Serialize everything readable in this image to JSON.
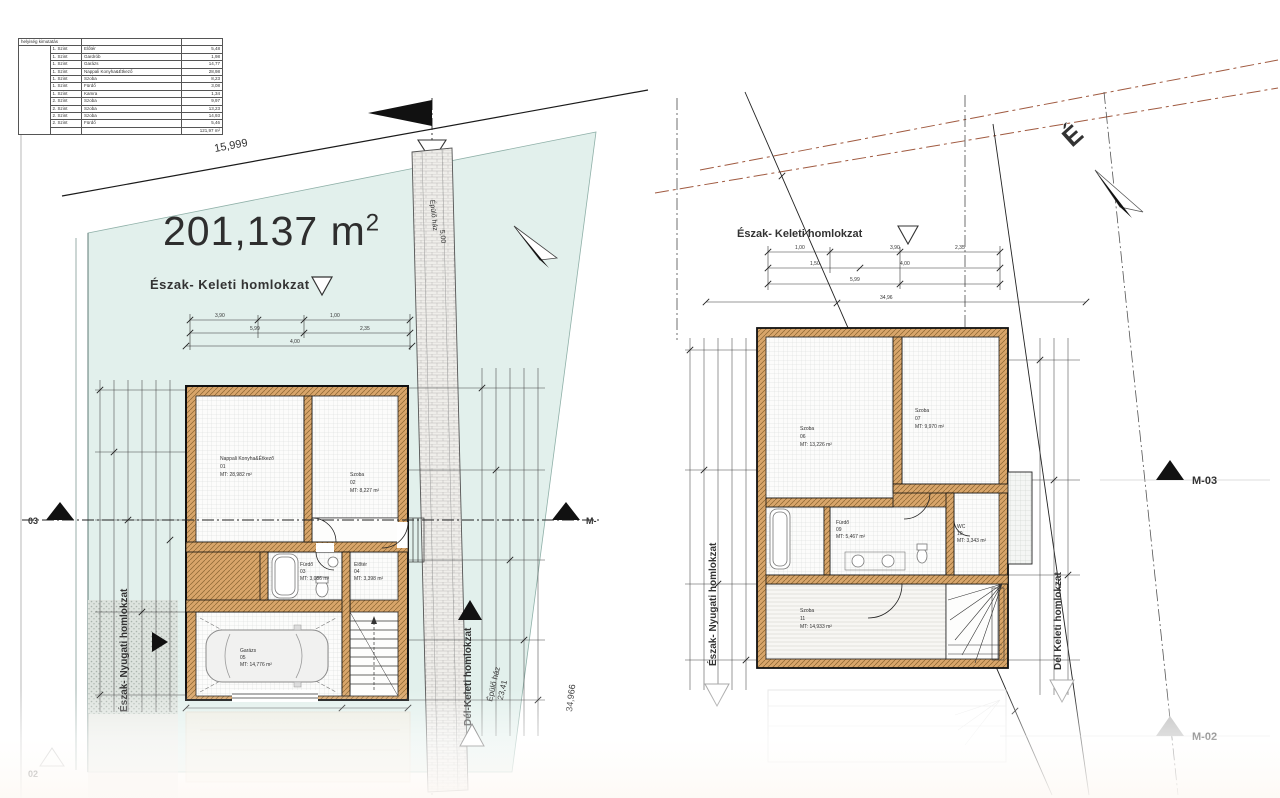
{
  "drawing": {
    "area_value": "201,137 m",
    "area_sup": "2"
  },
  "table": {
    "title": "helyiség kimutatás",
    "rows": [
      {
        "szint": "1. Szint",
        "name": "Előtér",
        "area": "5,48"
      },
      {
        "szint": "1. Szint",
        "name": "Gardrób",
        "area": "1,98"
      },
      {
        "szint": "1. Szint",
        "name": "Garázs",
        "area": "14,77"
      },
      {
        "szint": "1. Szint",
        "name": "Nappali Konyha&Étkező",
        "area": "28,98"
      },
      {
        "szint": "1. Szint",
        "name": "Szoba",
        "area": "8,23"
      },
      {
        "szint": "1. Szint",
        "name": "Fürdő",
        "area": "3,08"
      },
      {
        "szint": "1. Szint",
        "name": "Kamra",
        "area": "1,34"
      },
      {
        "szint": "2. Szint",
        "name": "Szoba",
        "area": "9,97"
      },
      {
        "szint": "2. Szint",
        "name": "Szoba",
        "area": "13,23"
      },
      {
        "szint": "2. Szint",
        "name": "Szoba",
        "area": "14,93"
      },
      {
        "szint": "2. Szint",
        "name": "Fürdő",
        "area": "5,46"
      }
    ],
    "total": "121,97 m²"
  },
  "left_plan": {
    "facade_top": "Észak- Keleti homlokzat",
    "facade_left": "Észak- Nyugati homlokzat",
    "facade_right": "Dél-Keleti homlokzat",
    "dim_top": "15,999",
    "dim_right": "34,966",
    "building_line": "Épülő ház",
    "building_dim": "23,41",
    "strip_text": "Épülő ház",
    "strip_dim": "5,00",
    "marker_left": "03",
    "marker_right": "M-",
    "marker_far_bottom": "02",
    "rooms": [
      {
        "name": "Nappali Konyha&Étkező",
        "num": "01",
        "area": "MT: 28,982 m²"
      },
      {
        "name": "Szoba",
        "num": "02",
        "area": "MT: 8,227 m²"
      },
      {
        "name": "Fürdő",
        "num": "03",
        "area": "MT: 3,086 m²"
      },
      {
        "name": "Előtér",
        "num": "04",
        "area": "MT: 3,398 m²"
      },
      {
        "name": "Garázs",
        "num": "05",
        "area": "MT: 14,776 m²"
      }
    ]
  },
  "right_plan": {
    "facade_top": "Észak- Keleti homlokzat",
    "facade_left": "Észak- Nyugati homlokzat",
    "facade_right": "Dél Keleti homlokzat",
    "marker_right": "M-03",
    "marker_bottom": "M-02",
    "north": "É",
    "rooms": [
      {
        "name": "Szoba",
        "num": "06",
        "area": "MT: 13,226 m²"
      },
      {
        "name": "Szoba",
        "num": "07",
        "area": "MT: 9,970 m²"
      },
      {
        "name": "Fürdő",
        "num": "09",
        "area": "MT: 5,467 m²"
      },
      {
        "name": "WC",
        "num": "10",
        "area": "MT: 3,343 m²"
      },
      {
        "name": "Szoba",
        "num": "11",
        "area": "MT: 14,933 m²"
      }
    ]
  },
  "dims": {
    "d1": "3,90",
    "d2": "1,00",
    "d3": "5,99",
    "d4": "2,35",
    "d5": "1,50",
    "d6": "4,00",
    "d7": "34,96"
  }
}
